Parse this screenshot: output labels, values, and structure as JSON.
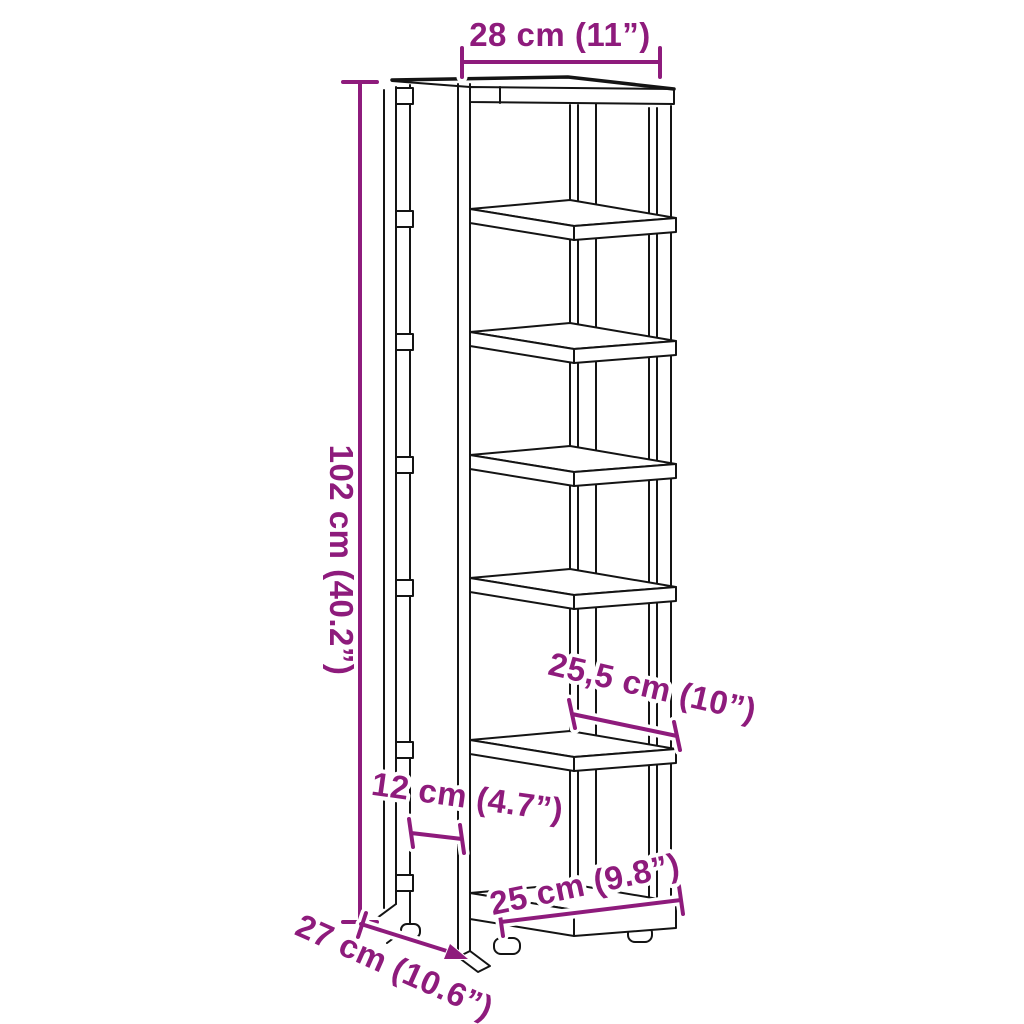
{
  "diagram": {
    "type": "furniture-dimension-diagram",
    "subject": "tall narrow shoe rack with 7 shelves, line drawing",
    "shelf_count": 7,
    "dimensions": {
      "top_width": "28 cm (11”)",
      "height": "102 cm (40.2”)",
      "middle_depth": "25,5 cm (10”)",
      "side_gap": "12 cm (4.7”)",
      "bottom_width": "25 cm (9.8”)",
      "bottom_depth": "27 cm (10.6”)"
    },
    "colors": {
      "dimension_annotations": "#8E1B7C",
      "outline": "#141414",
      "background": "#FFFFFF"
    }
  }
}
